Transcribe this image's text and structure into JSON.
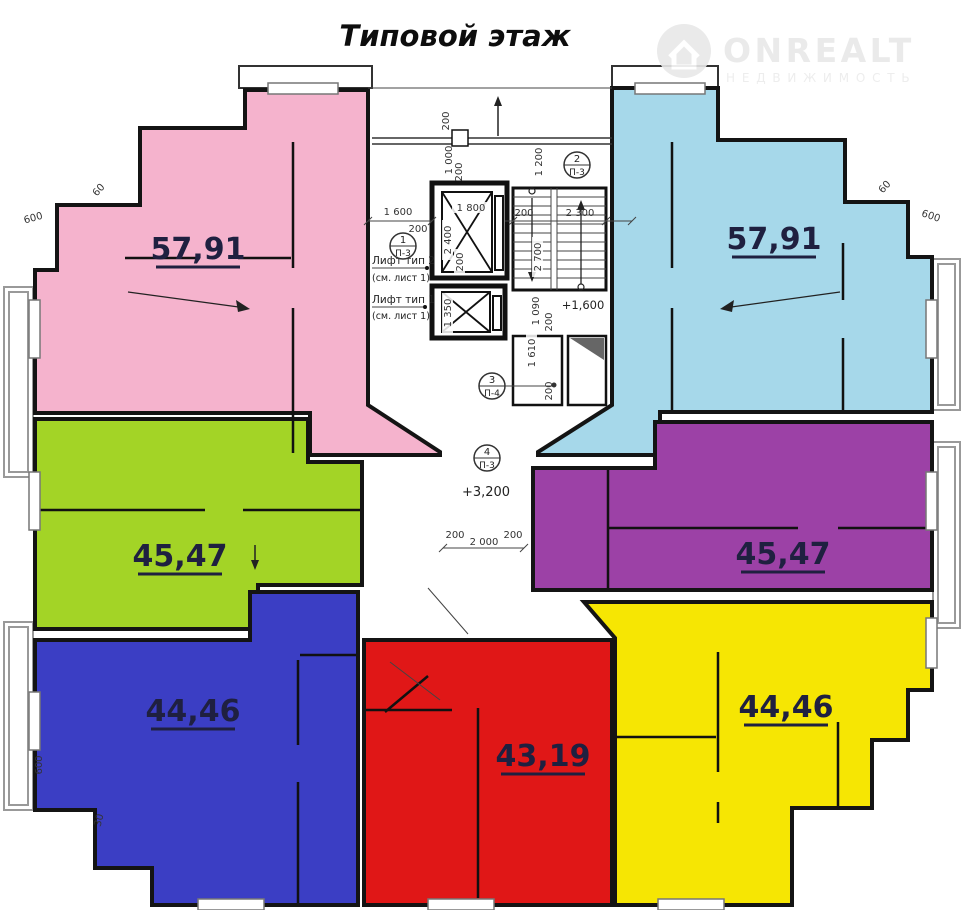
{
  "title": "Типовой этаж",
  "watermark": {
    "brand": "ONREALT",
    "tagline": "НЕДВИЖИМОСТЬ",
    "icon": "house-circle-icon"
  },
  "apartments": [
    {
      "name": "top-left",
      "area": "57,91",
      "color": "#f5b3cd"
    },
    {
      "name": "top-right",
      "area": "57,91",
      "color": "#a6d8ea"
    },
    {
      "name": "middle-left",
      "area": "45,47",
      "color": "#a3d426"
    },
    {
      "name": "middle-right",
      "area": "45,47",
      "color": "#9c41a6"
    },
    {
      "name": "bottom-left",
      "area": "44,46",
      "color": "#3b3ec4"
    },
    {
      "name": "bottom-center",
      "area": "43,19",
      "color": "#e01717"
    },
    {
      "name": "bottom-right",
      "area": "44,46",
      "color": "#f6e603"
    }
  ],
  "core": {
    "lift2": {
      "label": "Лифт тип 2",
      "note": "(см. лист 1)"
    },
    "lift1": {
      "label": "Лифт тип 1",
      "note": "(см. лист 1)"
    },
    "level_stairs": "+1,600",
    "level_floor": "+3,200",
    "markers": [
      {
        "num": "1",
        "code": "П-3"
      },
      {
        "num": "2",
        "code": "П-3"
      },
      {
        "num": "3",
        "code": "П-4"
      },
      {
        "num": "4",
        "code": "П-3"
      }
    ]
  },
  "dims": [
    "200",
    "1 000",
    "200",
    "1 200",
    "1 600",
    "200",
    "1 800",
    "2 400",
    "200",
    "200",
    "2 300",
    "2 700",
    "1 350",
    "1 090",
    "200",
    "1 610",
    "200",
    "2 000",
    "200",
    "600",
    "600",
    "600",
    "60",
    "60",
    "30",
    "200"
  ]
}
